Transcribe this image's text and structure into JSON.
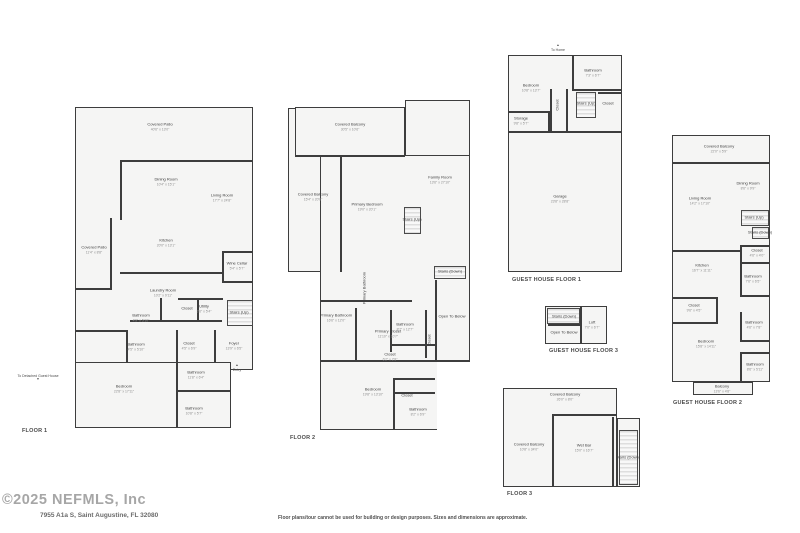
{
  "page": {
    "watermark": "©2025 NEFMLS, Inc",
    "address": "7955 A1a S, Saint Augustine, FL 32080",
    "disclaimer": "Floor plans/tour cannot be used for building or design purposes. Sizes and dimensions are approximate."
  },
  "colors": {
    "wall": "#3d3d3d",
    "floor_fill": "#f5f5f4",
    "room_text": "#3e3e3e",
    "dim_text": "#8f8f8f",
    "watermark_text": "#a6a6a6"
  },
  "plans": [
    {
      "id": "floor1",
      "label": "FLOOR 1",
      "rooms": [
        {
          "name": "Covered Patio",
          "dims": "40'6\" x 13'0\""
        },
        {
          "name": "Dining Room",
          "dims": "10'4\" x 15'1\""
        },
        {
          "name": "Living Room",
          "dims": "17'7\" x 24'8\""
        },
        {
          "name": "Kitchen",
          "dims": "20'0\" x 13'1\""
        },
        {
          "name": "Covered Patio",
          "dims": "11'4\" x 8'8\""
        },
        {
          "name": "Wine Cellar",
          "dims": "5'4\" x 5'7\""
        },
        {
          "name": "Laundry Room",
          "dims": "10'2\" x 9'11\""
        },
        {
          "name": "Bathroom",
          "dims": "4'9\" x 5'10\""
        },
        {
          "name": "Closet",
          "dims": ""
        },
        {
          "name": "Utility",
          "dims": "3'6\" x 5'4\""
        },
        {
          "name": "Stairs (Up)",
          "dims": ""
        },
        {
          "name": "Bathroom",
          "dims": "4'5\" x 5'10\""
        },
        {
          "name": "Closet",
          "dims": "4'5\" x 6'9\""
        },
        {
          "name": "Foyer",
          "dims": "13'9\" x 6'5\""
        },
        {
          "name": "Bedroom",
          "dims": "22'8\" x 17'11\""
        },
        {
          "name": "Bathroom",
          "dims": "11'8\" x 6'4\""
        },
        {
          "name": "Bathroom",
          "dims": "10'8\" x 5'7\""
        }
      ]
    },
    {
      "id": "floor2",
      "label": "FLOOR 2",
      "rooms": [
        {
          "name": "Covered Balcony",
          "dims": "30'5\" x 10'6\""
        },
        {
          "name": "Family Room",
          "dims": "13'6\" x 27'10\""
        },
        {
          "name": "Covered Balcony",
          "dims": "15'4\" x 20'8\""
        },
        {
          "name": "Primary Bedroom",
          "dims": "19'0\" x 20'1\""
        },
        {
          "name": "Stairs (Up)",
          "dims": ""
        },
        {
          "name": "Primary Bathroom",
          "dims": ""
        },
        {
          "name": "Bathroom",
          "dims": "8'7\" x 12'7\""
        },
        {
          "name": "Stairs (Down)",
          "dims": ""
        },
        {
          "name": "Open To Below",
          "dims": ""
        },
        {
          "name": "Primary Bathroom",
          "dims": "16'6\" x 12'0\""
        },
        {
          "name": "Primary Closet",
          "dims": "11'10\" x 10'7\""
        },
        {
          "name": "Closet",
          "dims": ""
        },
        {
          "name": "Closet",
          "dims": "6'2\" x 2'8\""
        },
        {
          "name": "Bedroom",
          "dims": "19'8\" x 13'10\""
        },
        {
          "name": "Closet",
          "dims": ""
        },
        {
          "name": "Bathroom",
          "dims": "8'2\" x 6'9\""
        }
      ]
    },
    {
      "id": "guesthouse1",
      "label": "GUEST HOUSE FLOOR 1",
      "rooms": [
        {
          "name": "Bedroom",
          "dims": "10'8\" x 13'7\""
        },
        {
          "name": "Bathroom",
          "dims": "7'3\" x 6'7\""
        },
        {
          "name": "Closet",
          "dims": ""
        },
        {
          "name": "Stairs (Up)",
          "dims": ""
        },
        {
          "name": "Closet",
          "dims": ""
        },
        {
          "name": "Storage",
          "dims": "9'8\" x 5'7\""
        },
        {
          "name": "Garage",
          "dims": "23'8\" x 28'8\""
        }
      ]
    },
    {
      "id": "guesthouse3",
      "label": "GUEST HOUSE FLOOR 3",
      "rooms": [
        {
          "name": "Stairs (Down)",
          "dims": ""
        },
        {
          "name": "Open To Below",
          "dims": ""
        },
        {
          "name": "Loft",
          "dims": "7'0\" x 6'7\""
        }
      ]
    },
    {
      "id": "guesthouse2",
      "label": "GUEST HOUSE FLOOR 2",
      "rooms": [
        {
          "name": "Covered Balcony",
          "dims": "22'0\" x 5'9\""
        },
        {
          "name": "Dining Room",
          "dims": "8'6\" x 9'9\""
        },
        {
          "name": "Living Room",
          "dims": "14'2\" x 17'10\""
        },
        {
          "name": "Stairs (Up)",
          "dims": ""
        },
        {
          "name": "Stairs (Down)",
          "dims": ""
        },
        {
          "name": "Closet",
          "dims": "4'6\" x 4'0\""
        },
        {
          "name": "Kitchen",
          "dims": "16'7\" x 11'11\""
        },
        {
          "name": "Bathroom",
          "dims": "7'6\" x 6'5\""
        },
        {
          "name": "Closet",
          "dims": "9'6\" x 4'5\""
        },
        {
          "name": "Bathroom",
          "dims": "4'6\" x 7'8\""
        },
        {
          "name": "Bedroom",
          "dims": "15'8\" x 14'11\""
        },
        {
          "name": "Bathroom",
          "dims": "8'6\" x 5'11\""
        },
        {
          "name": "Balcony",
          "dims": "13'6\" x 4'8\""
        }
      ]
    },
    {
      "id": "floor3",
      "label": "FLOOR 3",
      "rooms": [
        {
          "name": "Covered Balcony",
          "dims": "26'0\" x 8'0\""
        },
        {
          "name": "Covered Balcony",
          "dims": "10'8\" x 34'0\""
        },
        {
          "name": "Wet Bar",
          "dims": "15'0\" x 16'7\""
        },
        {
          "name": "Stairs (Down)",
          "dims": ""
        }
      ]
    }
  ],
  "annotations": [
    {
      "id": "to-home",
      "text": "To Home"
    },
    {
      "id": "entry",
      "text": "Entry"
    },
    {
      "id": "to-detached",
      "text": "To Detached Guest House"
    }
  ]
}
